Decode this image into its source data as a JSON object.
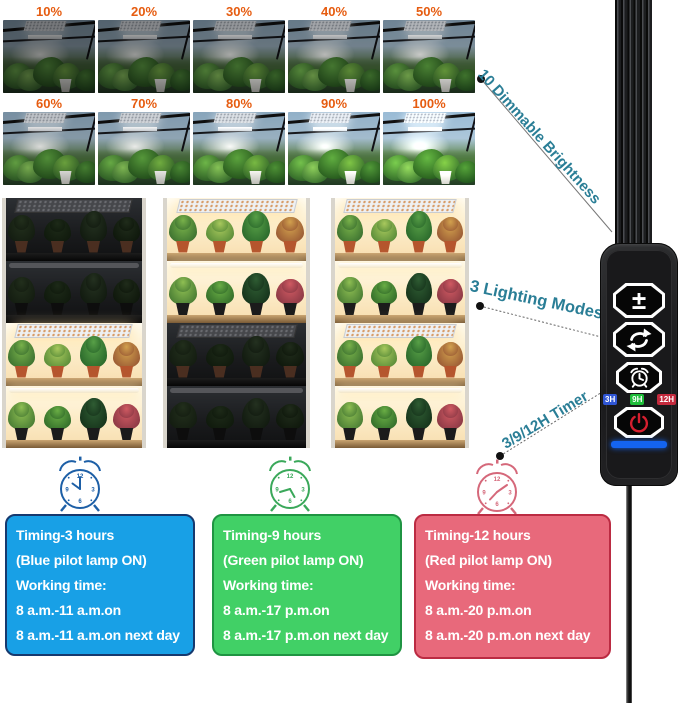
{
  "brightness_grid": {
    "levels": [
      "10%",
      "20%",
      "30%",
      "40%",
      "50%",
      "60%",
      "70%",
      "80%",
      "90%",
      "100%"
    ]
  },
  "middle_gallery": [
    {
      "name": "shelf-photo-left",
      "lit_shelves": [
        false,
        false,
        true,
        true
      ]
    },
    {
      "name": "shelf-photo-middle",
      "lit_shelves": [
        true,
        true,
        false,
        false
      ]
    },
    {
      "name": "shelf-photo-right",
      "lit_shelves": [
        true,
        true,
        true,
        true
      ]
    }
  ],
  "annotations": {
    "dimmable": "10 Dimmable Brightness",
    "modes": "3 Lighting Modes",
    "timer": "3/9/12H Timer"
  },
  "controller": {
    "buttons": [
      {
        "name": "brightness",
        "glyph": "±"
      },
      {
        "name": "mode"
      },
      {
        "name": "timer"
      },
      {
        "name": "power"
      }
    ],
    "timer_badges": [
      {
        "label": "3H",
        "color": "#2f55d4"
      },
      {
        "label": "9H",
        "color": "#1fbe3a"
      },
      {
        "label": "12H",
        "color": "#c42a3d"
      }
    ],
    "indicator_color": "#1464f0"
  },
  "timing_cards": [
    {
      "lines": [
        "Timing-3 hours",
        "(Blue pilot lamp ON)",
        "Working time:",
        "8 a.m.-11 a.m.on",
        "8 a.m.-11 a.m.on next day"
      ],
      "bg": "#18a0e6",
      "border": "#16396e",
      "clock_color": "#1d5fa6"
    },
    {
      "lines": [
        "Timing-9 hours",
        "(Green pilot lamp ON)",
        "Working time:",
        "8 a.m.-17 p.m.on",
        "8 a.m.-17 p.m.on next day"
      ],
      "bg": "#41d066",
      "border": "#1f9442",
      "clock_color": "#3aa85a"
    },
    {
      "lines": [
        "Timing-12 hours",
        "(Red pilot lamp ON)",
        "Working time:",
        "8 a.m.-20 p.m.on",
        "8 a.m.-20 p.m.on next day"
      ],
      "bg": "#e8697b",
      "border": "#bb2b42",
      "clock_color": "#d5687a"
    }
  ],
  "colors": {
    "percent_label": "#e65c10",
    "annotation_text": "#2a7e96"
  }
}
